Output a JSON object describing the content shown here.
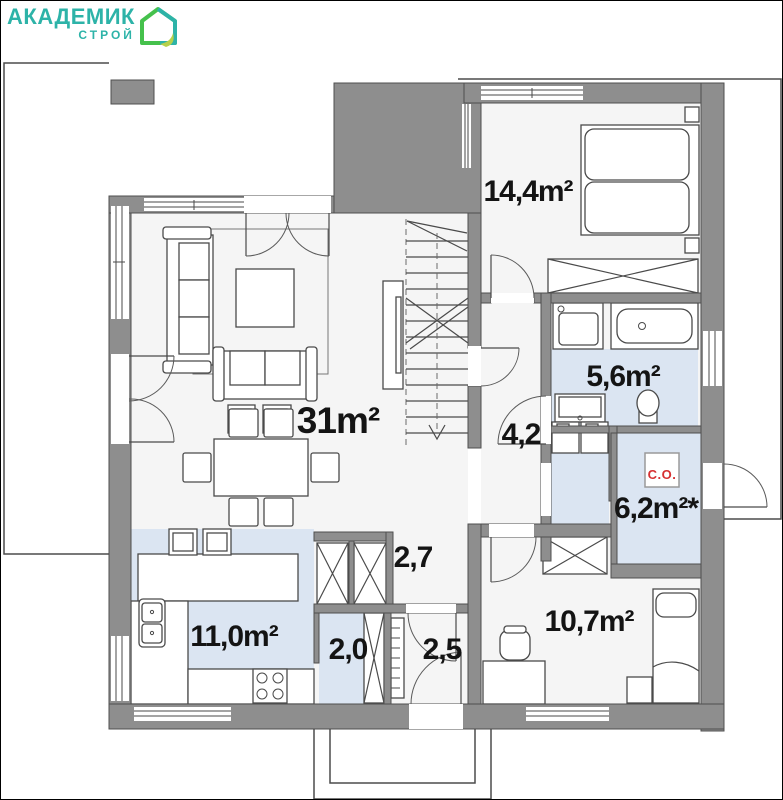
{
  "logo": {
    "brand": "АКАДЕМИК",
    "sub": "СТРОЙ"
  },
  "plan": {
    "labels": [
      {
        "room": "bedroom-main",
        "text": "14,4m²"
      },
      {
        "room": "living-room",
        "text": "31m²"
      },
      {
        "room": "bathroom",
        "text": "5,6m²"
      },
      {
        "room": "hall",
        "text": "4,2"
      },
      {
        "room": "boiler-room",
        "text": "6,2m²*"
      },
      {
        "room": "corridor",
        "text": "2,7"
      },
      {
        "room": "pantry",
        "text": "2,0"
      },
      {
        "room": "entry",
        "text": "2,5"
      },
      {
        "room": "kitchen",
        "text": "11,0m²"
      },
      {
        "room": "bedroom-second",
        "text": "10,7m²"
      }
    ],
    "heating_unit_label": "С.О."
  },
  "colors": {
    "wall": "#8e8e8e",
    "floor": "#f5f5f5",
    "wet_floor": "#dbe5f2",
    "logo_teal": "#2db3a8",
    "logo_green": "#45c14c",
    "logo_leaf": "#b7d14b",
    "heating_red": "#d63031",
    "line": "#4a4a4a"
  }
}
